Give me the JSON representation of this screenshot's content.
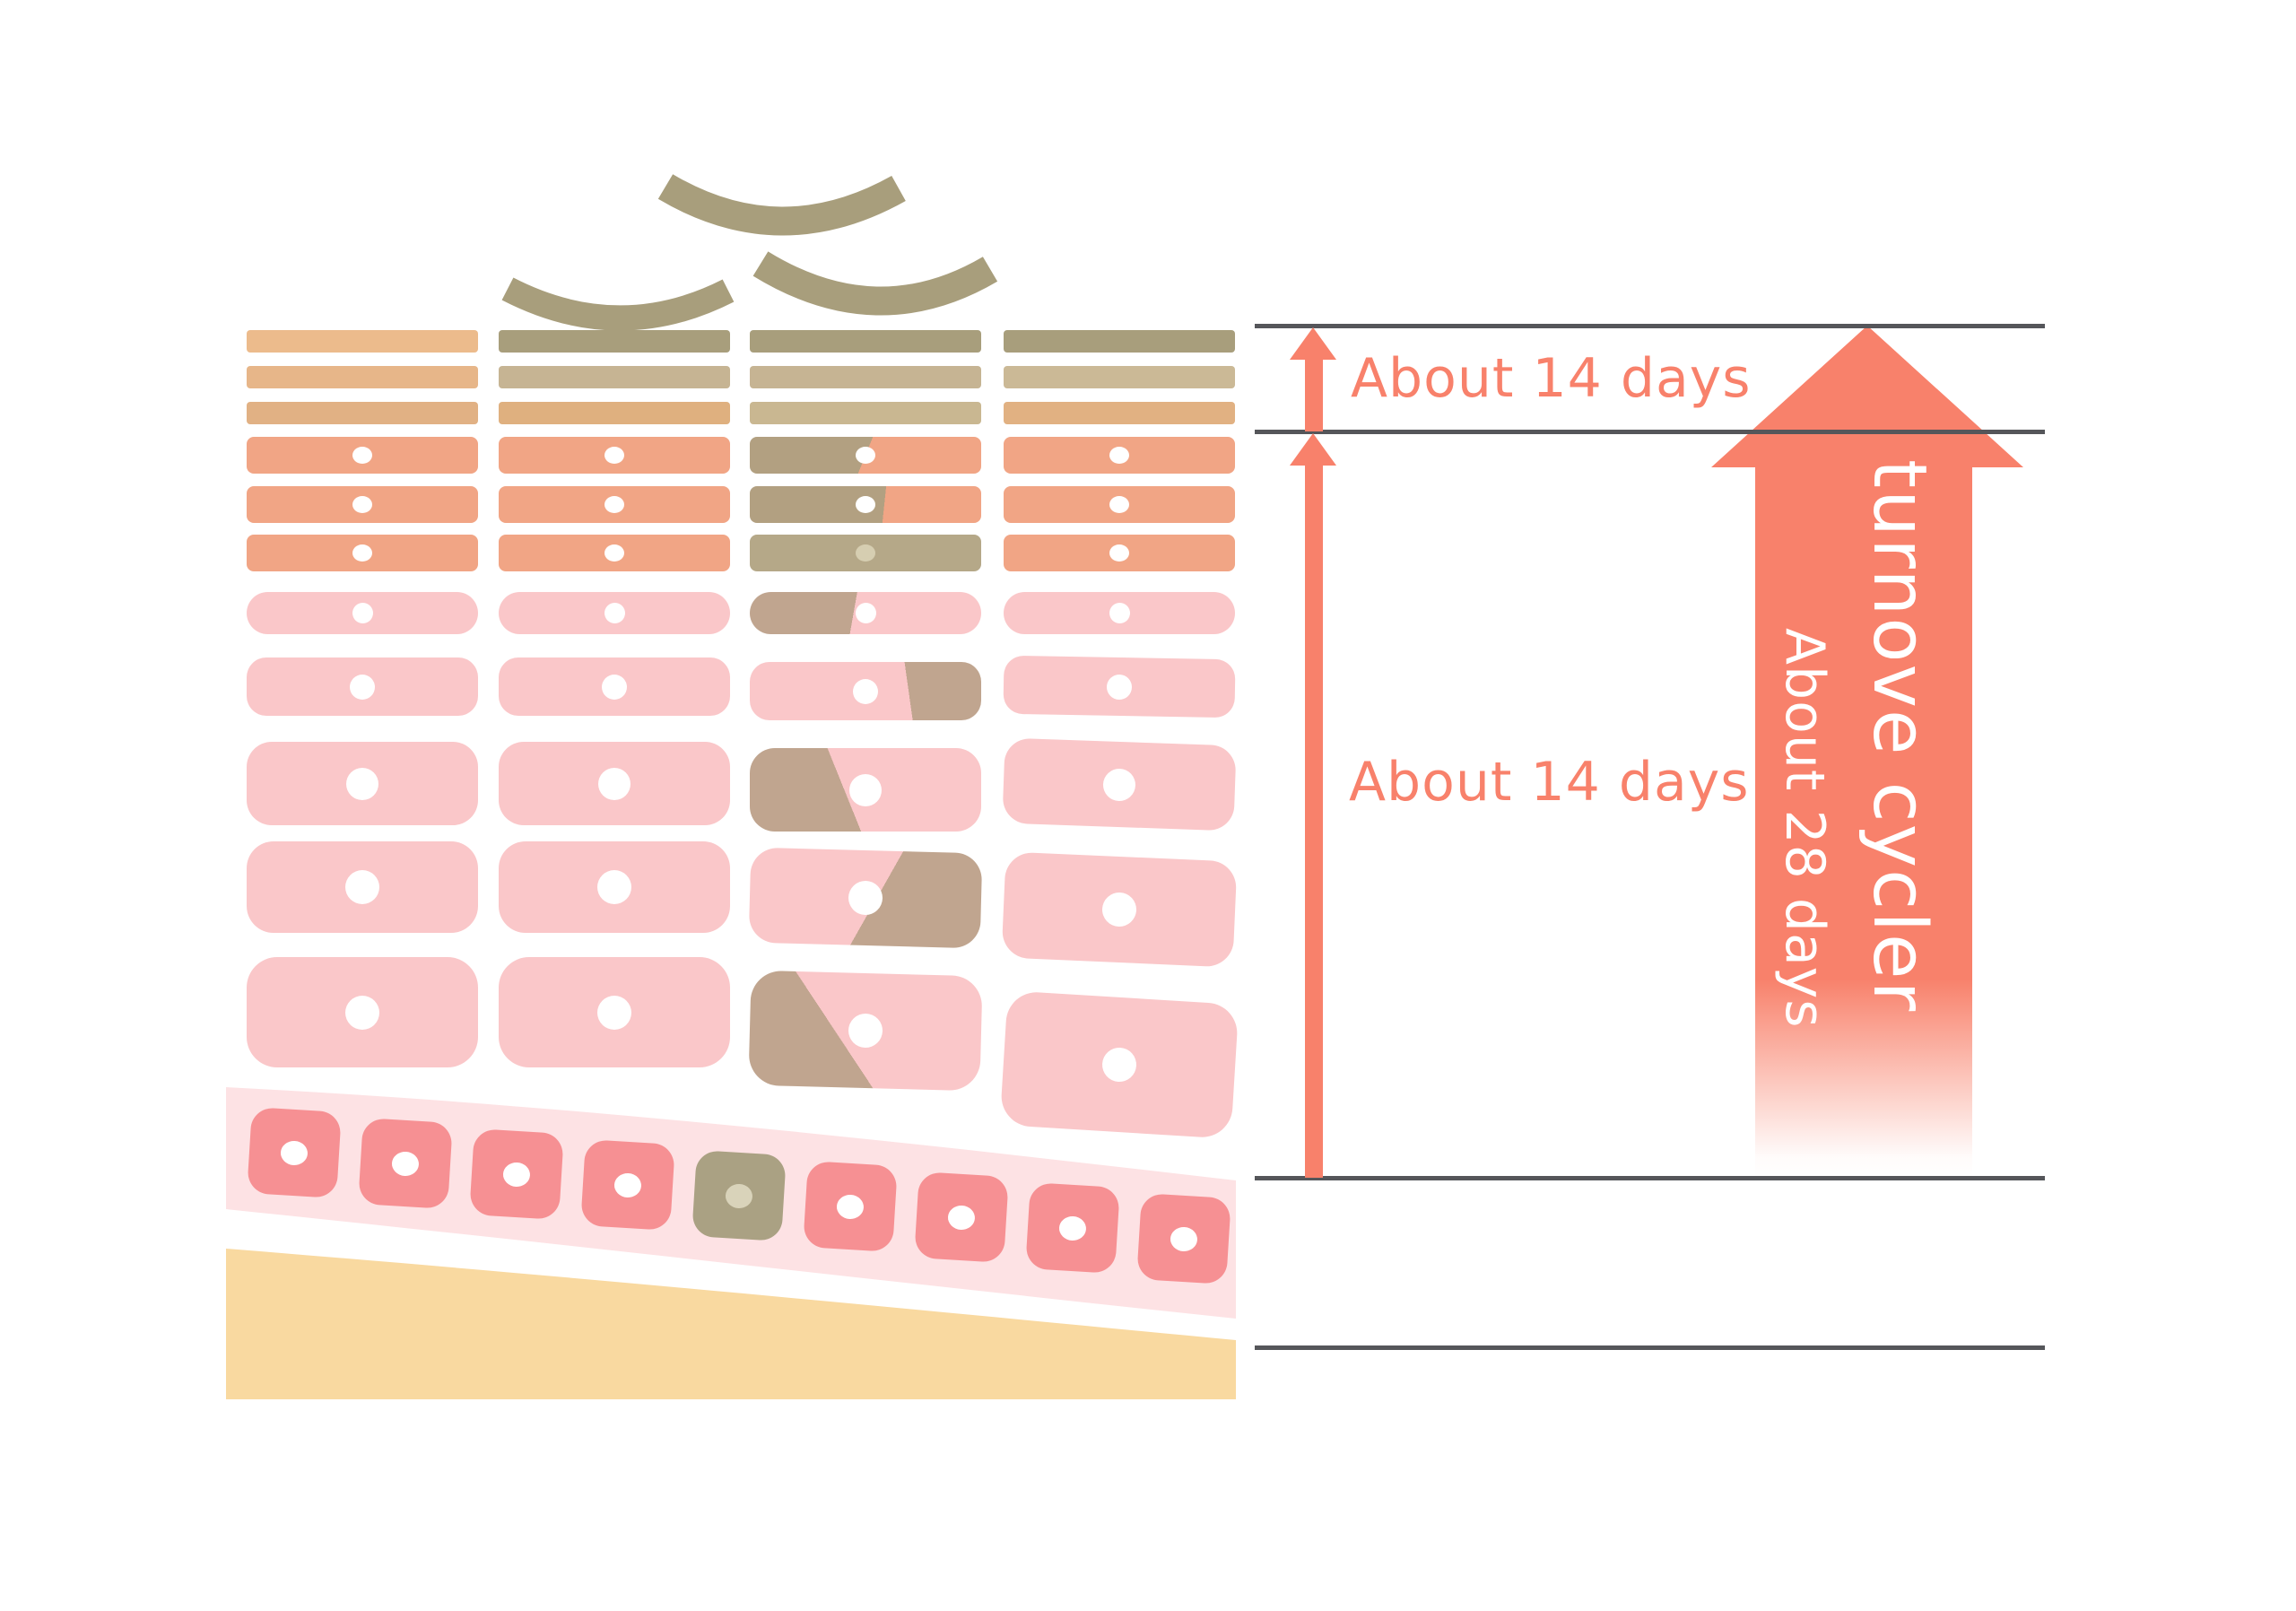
{
  "right_panel": {
    "top_label": "About 14 days",
    "middle_label": "About 14 days",
    "arrow_title": "turnove cycler",
    "arrow_subtitle": "About 28 days"
  },
  "colors": {
    "coral": "#f8816b",
    "line_gray": "#55565a",
    "corneum_olive": "#a89e7c",
    "corneum_tan_light": "#c6b493",
    "corneum_col1_row1": "#ecbb8c",
    "corneum_col1_row2": "#e7b689",
    "corneum_col1_row3": "#e1b184",
    "corneum_col2_row3": "#dfb07f",
    "corneum_col3_row3": "#c9b791",
    "corneum_col4_row2": "#cbb996",
    "corneum_col4_row3": "#e1b182",
    "granular_salmon": "#f1a585",
    "granular_olive": "#b2a081",
    "granular_dead": "#b5a888",
    "granular_dead_nucleus": "#d6ceb1",
    "spinous_pink": "#fac7c9",
    "spinous_olive": "#c0a58f",
    "basal_band_pink": "#fde2e4",
    "basal_cell": "#f69093",
    "basal_dead_cell": "#aaa183",
    "basal_dead_nucleus": "#d9d3ba",
    "dermis_sand": "#f9d9a0",
    "nucleus_white": "#ffffff"
  }
}
